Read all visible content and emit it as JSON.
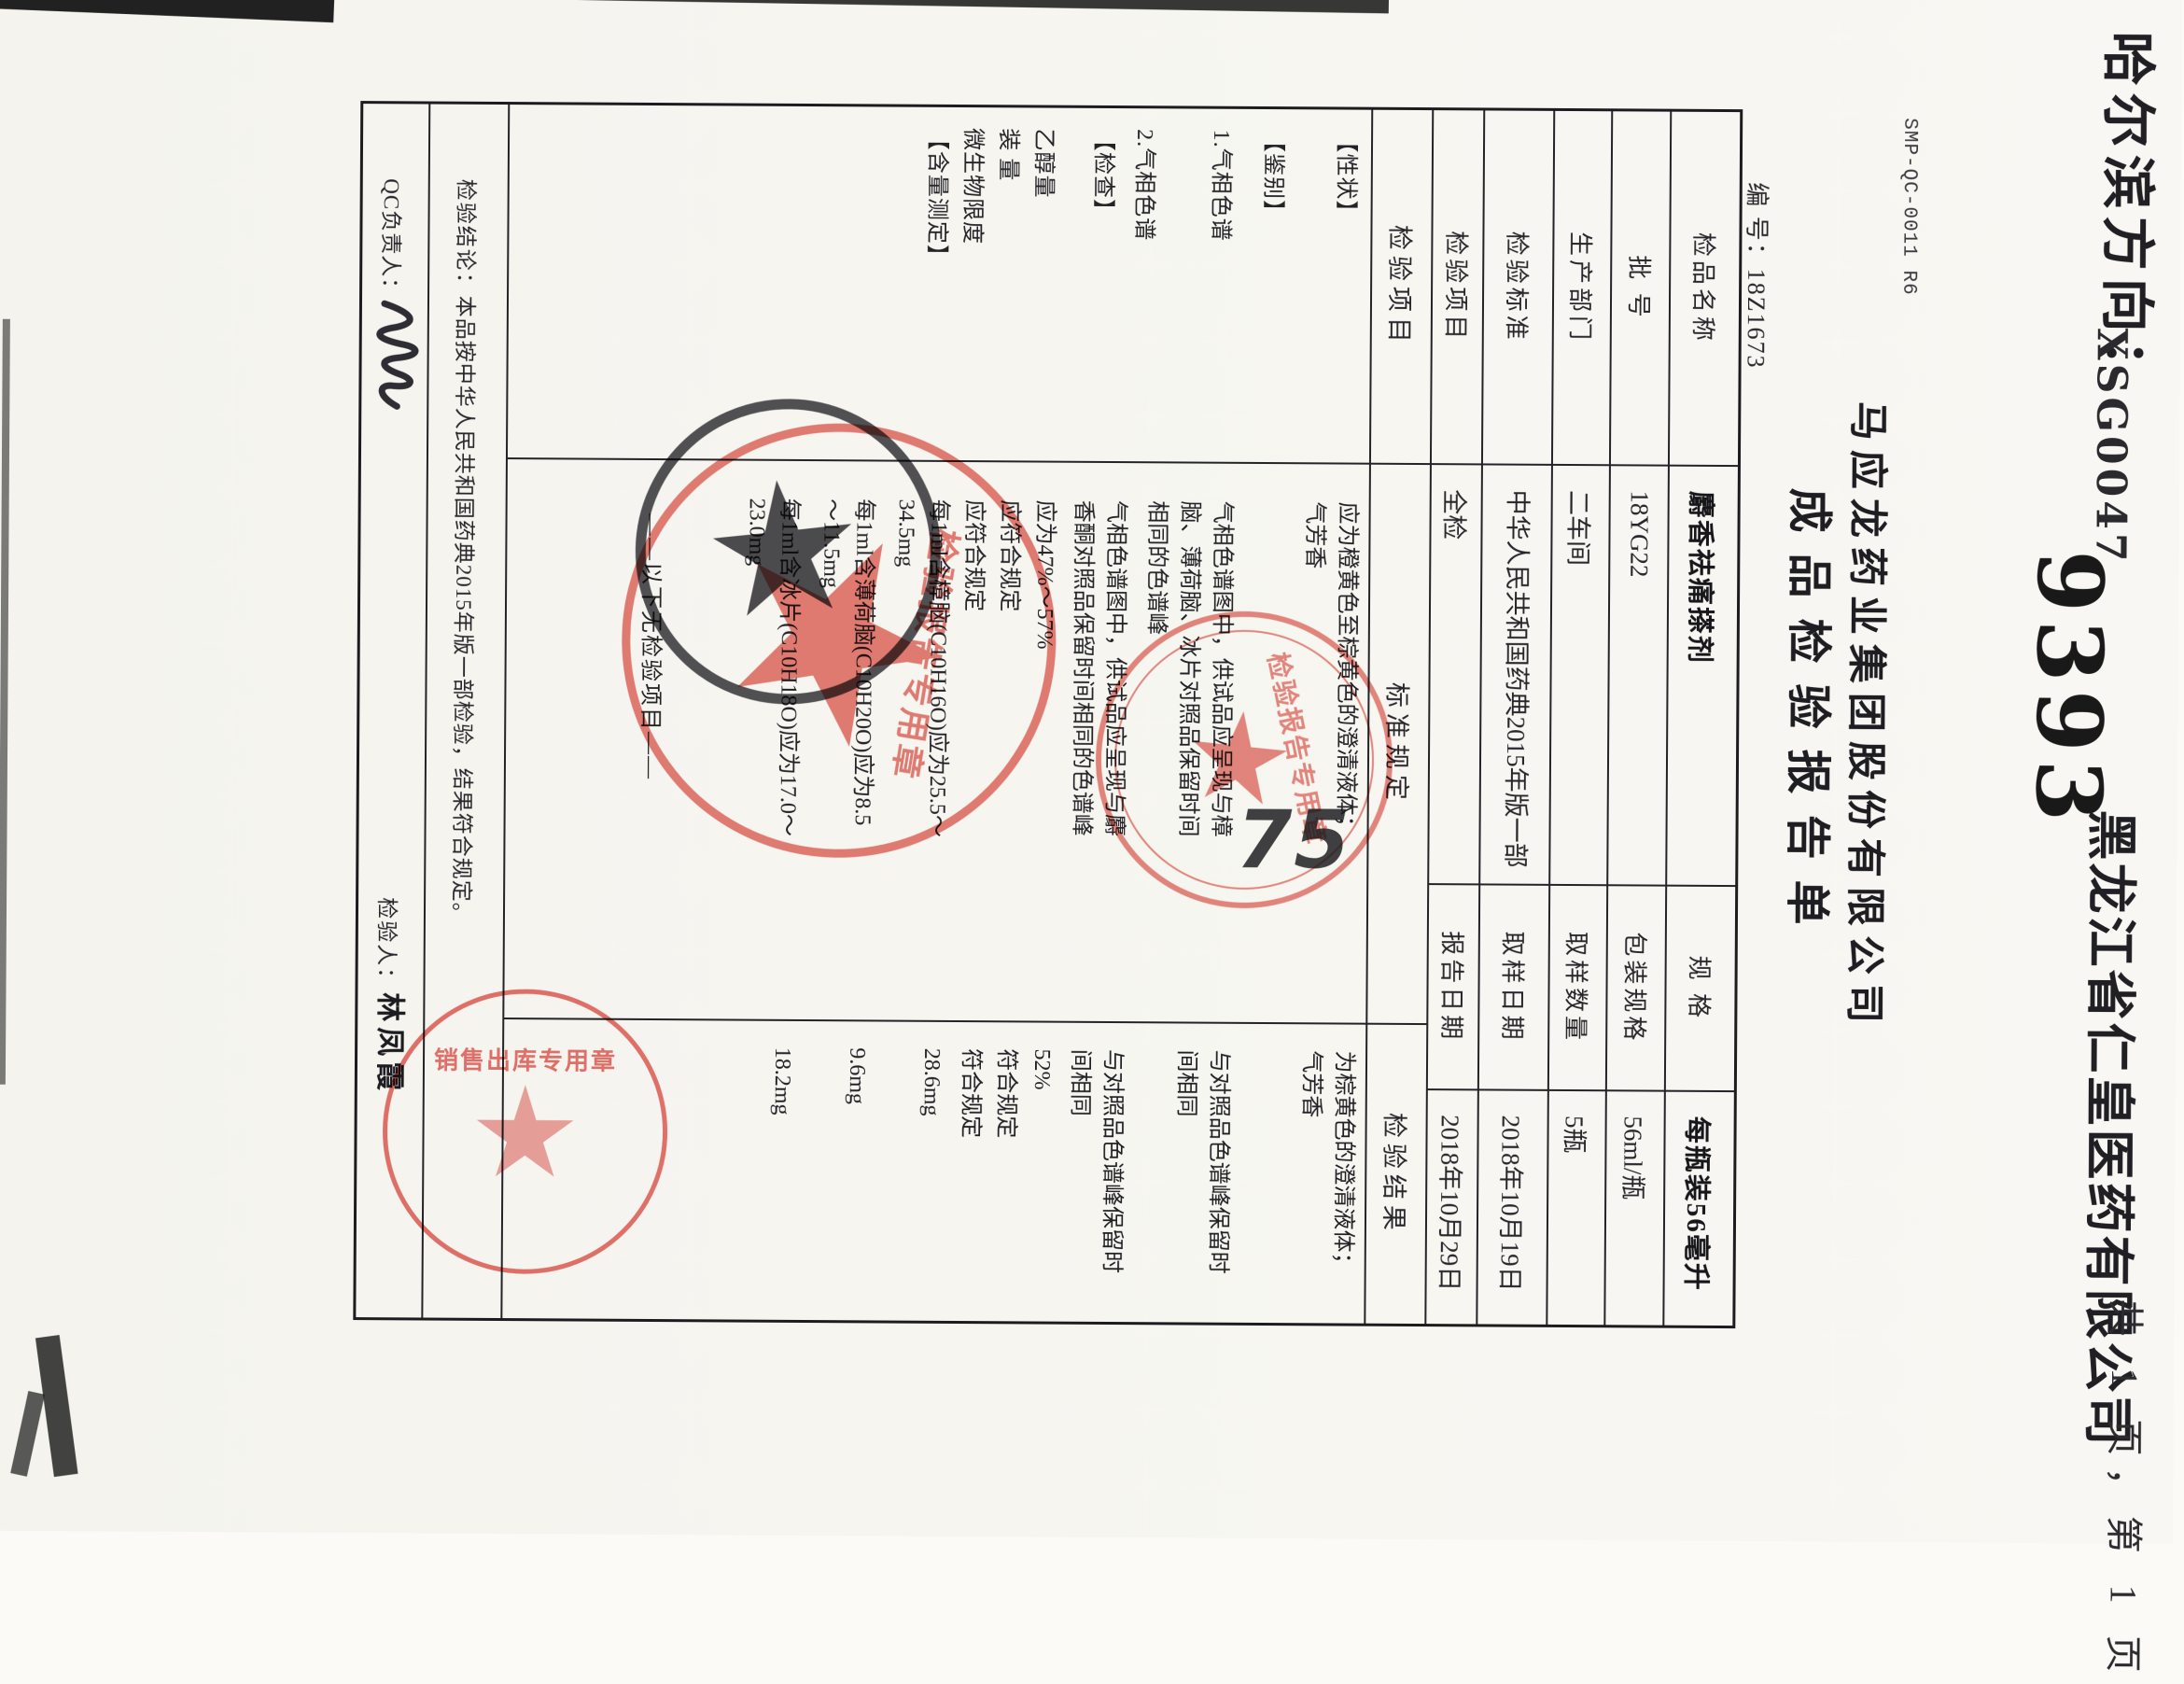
{
  "fax_header": {
    "destination": "哈尔滨方向：",
    "waybill_code": "XSG0047",
    "waybill_number": "9393",
    "recipient": "黑龙江省仁皇医药有限公司",
    "pagination": "共 1 页，第 1 页"
  },
  "document": {
    "form_code": "SMP-QC-0011  R6",
    "company": "马应龙药业集团股份有限公司",
    "title": "成品检验报告单",
    "number_label": "编  号：",
    "number": "18Z1673",
    "info": [
      {
        "l1": "检品名称",
        "v1": "麝香祛痛搽剂",
        "l2": "规  格",
        "v2": "每瓶装56毫升"
      },
      {
        "l1": "批  号",
        "v1": "18YG22",
        "l2": "包装规格",
        "v2": "56ml/瓶"
      },
      {
        "l1": "生产部门",
        "v1": "二车间",
        "l2": "取样数量",
        "v2": "5瓶"
      },
      {
        "l1": "检验标准",
        "v1": "中华人民共和国药典2015年版一部",
        "l2": "取样日期",
        "v2": "2018年10月19日"
      },
      {
        "l1": "检验项目",
        "v1": "全检",
        "l2": "报告日期",
        "v2": "2018年10月29日"
      }
    ],
    "columns": {
      "item": "检验项目",
      "spec": "标准规定",
      "result": "检验结果"
    },
    "items": [
      "【性状】",
      "【鉴别】",
      "1.气相色谱",
      "2.气相色谱",
      "【检查】",
      "乙醇量",
      "装  量",
      "微生物限度",
      "【含量测定】"
    ],
    "specs": {
      "xingzhuang": "应为橙黄色至棕黄色的澄清液体；气芳香",
      "jianbie1": "气相色谱图中，供试品应呈现与樟脑、薄荷脑、冰片对照品保留时间相同的色谱峰",
      "jianbie2": "气相色谱图中，供试品应呈现与麝香酮对照品保留时间相同的色谱峰",
      "yichunliang": "应为47%～57%",
      "zhuangliang": "应符合规定",
      "weishengwu": "应符合规定",
      "zhangnao": "每1ml含樟脑(C10H16O)应为25.5～34.5mg",
      "bohenao": "每1ml含薄荷脑(C10H20O)应为8.5～11.5mg",
      "bingpian": "每1ml含冰片(C10H18O)应为17.0～23.0mg",
      "no_more": "——以下无检验项目——"
    },
    "results": {
      "xingzhuang": "为棕黄色的澄清液体；气芳香",
      "jianbie1": "与对照品色谱峰保留时间相同",
      "jianbie2": "与对照品色谱峰保留时间相同",
      "yichunliang": "52%",
      "zhuangliang": "符合规定",
      "weishengwu": "符合规定",
      "zhangnao": "28.6mg",
      "bohenao": "9.6mg",
      "bingpian": "18.2mg"
    },
    "conclusion": {
      "label": "检验结论：",
      "text": "本品按中华人民共和国药典2015年版一部检验，结果符合规定。"
    },
    "signoff": {
      "qc_label": "QC负责人：",
      "inspector_label": "检验人：",
      "inspector_name": "林凤霞"
    }
  },
  "seals": {
    "maker_company": "马应龙药业集团股份有限公司",
    "maker_caption": "检验报告专用章",
    "receiver_company": "黑龙江九州通医药有限公司",
    "receiver_caption": "销售出库专用章"
  },
  "annotations": {
    "handwritten": "75"
  }
}
